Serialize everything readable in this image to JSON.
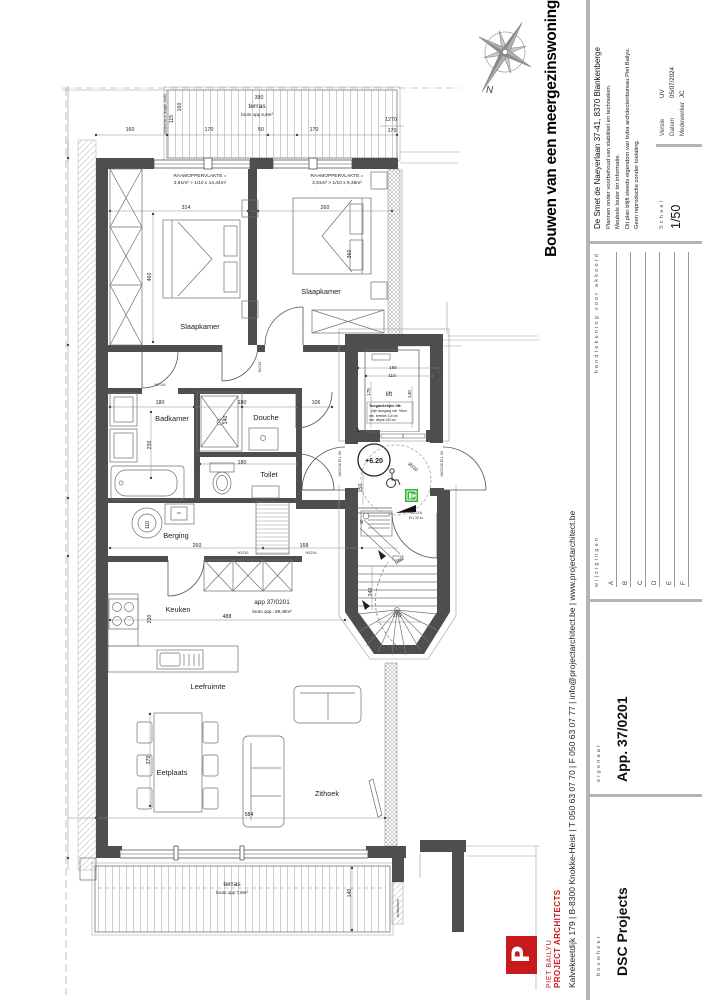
{
  "sheet": {
    "project_title": "Bouwen van een meergezinswoning",
    "project_address": "De Smet de Naeyerlaan 37-41, 8370 Blankenberge",
    "notes": "Plannen onder voorbehoud van stabiliteit en technieken.\nMeubels louter ter informatie.\nDit plan blijft steeds eigendom van bvba architectenbureau Piet Bailyu.\nGeen reproductie zonder toelating.",
    "versie_label": "Versie",
    "versie": "UV",
    "datum_label": "Datum",
    "datum": "05/07/2024",
    "medewerker_label": "Medewerker",
    "medewerker": "JC",
    "schaal_label": "Schaal",
    "schaal": "1/50",
    "wijzigingen_label": "wijzigingen",
    "handtekening_label": "handtekening voor akkoord",
    "revisions": [
      "A",
      "B",
      "C",
      "D",
      "E",
      "F"
    ],
    "bouwheer_label": "bouwheer",
    "bouwheer": "DSC Projects",
    "eigenaar_label": "eigenaar",
    "eigenaar": "App. 37/0201",
    "company_name": "PIET BAILYU",
    "company_sub": "PROJECT ARCHITECTS",
    "company_contact": "Kalvekeetdijk 179   |   B-8300 Knokke-Heist   |   T 050 63 07 70   |   F 050 63 07 77   |   info@projectarchitect.be   |   www.projectarchitect.be",
    "logo_letter": "P",
    "compass_label": "N"
  },
  "colors": {
    "wall": "#4e4e4e",
    "accent_red": "#c8191c",
    "exit_green": "#2eb135",
    "bar_gray": "#b3b3b3"
  },
  "plan": {
    "labels": [
      {
        "n": "label-terras-top",
        "t": "terras",
        "x": 257,
        "y": 108,
        "s": 6.8
      },
      {
        "n": "label-terras-top-opp",
        "t": "bruto opp 6,8m²",
        "x": 257,
        "y": 116,
        "s": 4.5
      },
      {
        "n": "label-slaapkamer-1",
        "t": "Slaapkamer",
        "x": 200,
        "y": 329,
        "s": 7.4
      },
      {
        "n": "label-slaapkamer-2",
        "t": "Slaapkamer",
        "x": 321,
        "y": 294,
        "s": 7.4
      },
      {
        "n": "label-badkamer",
        "t": "Badkamer",
        "x": 172,
        "y": 421,
        "s": 7.4
      },
      {
        "n": "label-douche",
        "t": "Douche",
        "x": 266,
        "y": 420,
        "s": 7.4
      },
      {
        "n": "label-toilet",
        "t": "Toilet",
        "x": 269,
        "y": 477,
        "s": 7.4
      },
      {
        "n": "label-berging",
        "t": "Berging",
        "x": 176,
        "y": 538,
        "s": 7.4
      },
      {
        "n": "label-keuken",
        "t": "Keuken",
        "x": 178,
        "y": 612,
        "s": 7.4
      },
      {
        "n": "label-leefruimte",
        "t": "Leefruimte",
        "x": 208,
        "y": 689,
        "s": 7.4
      },
      {
        "n": "label-eetplaats",
        "t": "Eetplaats",
        "x": 172,
        "y": 775,
        "s": 7.4
      },
      {
        "n": "label-zithoek",
        "t": "Zithoek",
        "x": 327,
        "y": 796,
        "s": 7.4
      },
      {
        "n": "label-lift",
        "t": "lift",
        "x": 389,
        "y": 396,
        "s": 6.4
      },
      {
        "n": "label-terras-bottom",
        "t": "terras",
        "x": 232,
        "y": 886,
        "s": 6.8
      },
      {
        "n": "label-terras-bottom-opp",
        "t": "bruto opp 7,8m²",
        "x": 232,
        "y": 894,
        "s": 4.5
      },
      {
        "n": "label-app-number",
        "t": "app 37/0201",
        "x": 272,
        "y": 604,
        "s": 6.4
      },
      {
        "n": "label-app-opp",
        "t": "bruto opp.: 89,48m²",
        "x": 272,
        "y": 613,
        "s": 4.5
      },
      {
        "n": "label-level",
        "t": "+6.20",
        "x": 374,
        "y": 463,
        "s": 7,
        "b": 1
      },
      {
        "n": "label-raam1-1",
        "t": "RAAMOPPERVLAKTE =",
        "x": 200,
        "y": 177,
        "s": 4.8
      },
      {
        "n": "label-raam1-2",
        "t": "3,91m² > 1/10 x 14,44m²",
        "x": 200,
        "y": 184,
        "s": 4.8
      },
      {
        "n": "label-raam2-1",
        "t": "RAAMOPPERVLAKTE =",
        "x": 337,
        "y": 177,
        "s": 4.8
      },
      {
        "n": "label-raam2-2",
        "t": "3,91m² > 1/10 x 9,36m²",
        "x": 337,
        "y": 184,
        "s": 4.8
      },
      {
        "n": "dim-390",
        "t": "390",
        "x": 259,
        "y": 99
      },
      {
        "n": "dim-160-a",
        "t": "160",
        "x": 130,
        "y": 131
      },
      {
        "n": "dim-170-a",
        "t": "170",
        "x": 209,
        "y": 131
      },
      {
        "n": "dim-50",
        "t": "50",
        "x": 261,
        "y": 131
      },
      {
        "n": "dim-170-b",
        "t": "170",
        "x": 314,
        "y": 131
      },
      {
        "n": "dim-1270",
        "t": "1270",
        "x": 391,
        "y": 121
      },
      {
        "n": "dim-170-c",
        "t": "170",
        "x": 392,
        "y": 132
      },
      {
        "n": "dim-160-v",
        "t": "160",
        "x": 181,
        "y": 107,
        "r": -90
      },
      {
        "n": "dim-115-v",
        "t": "115",
        "x": 173,
        "y": 119,
        "r": -90
      },
      {
        "n": "note-zichtscherm-top",
        "t": "zichtscherm hoogte 1m80",
        "x": 166,
        "y": 114,
        "r": -90,
        "s": 3.5
      },
      {
        "n": "dim-314",
        "t": "314",
        "x": 186,
        "y": 209
      },
      {
        "n": "dim-460",
        "t": "460",
        "x": 151,
        "y": 277,
        "r": -90
      },
      {
        "n": "dim-260-bed",
        "t": "260",
        "x": 325,
        "y": 209
      },
      {
        "n": "dim-360",
        "t": "360",
        "x": 351,
        "y": 254,
        "r": -90
      },
      {
        "n": "dim-180-badkamer",
        "t": "180",
        "x": 160,
        "y": 404
      },
      {
        "n": "dim-180-douche",
        "t": "180",
        "x": 242,
        "y": 404
      },
      {
        "n": "dim-106",
        "t": "106",
        "x": 316,
        "y": 404
      },
      {
        "n": "dim-140-douche",
        "t": "140",
        "x": 227,
        "y": 420,
        "r": -90
      },
      {
        "n": "dim-230-badkamer",
        "t": "230",
        "x": 151,
        "y": 445,
        "r": -90
      },
      {
        "n": "dim-180-toilet",
        "t": "180",
        "x": 242,
        "y": 464
      },
      {
        "n": "dim-260-berging",
        "t": "260",
        "x": 197,
        "y": 547
      },
      {
        "n": "dim-168",
        "t": "168",
        "x": 304,
        "y": 547
      },
      {
        "n": "dim-110",
        "t": "110",
        "x": 149,
        "y": 525,
        "r": -90
      },
      {
        "n": "dim-230-keuken",
        "t": "230",
        "x": 151,
        "y": 619,
        "r": -90
      },
      {
        "n": "dim-488",
        "t": "488",
        "x": 227,
        "y": 618
      },
      {
        "n": "dim-370",
        "t": "370",
        "x": 150,
        "y": 760,
        "r": -90
      },
      {
        "n": "dim-584",
        "t": "584",
        "x": 249,
        "y": 816
      },
      {
        "n": "dim-140-terras",
        "t": "140",
        "x": 351,
        "y": 893,
        "r": -90
      },
      {
        "n": "note-zichtscherm-bottom",
        "t": "zichtscherm",
        "x": 399,
        "y": 908,
        "r": -90,
        "s": 3.5
      },
      {
        "n": "dim-160-lift",
        "t": "160",
        "x": 393,
        "y": 369,
        "s": 4.6
      },
      {
        "n": "dim-110-lift",
        "t": "110",
        "x": 392,
        "y": 377,
        "s": 4.6
      },
      {
        "n": "dim-175-lift",
        "t": "175",
        "x": 370,
        "y": 392,
        "r": -90,
        "s": 4.6
      },
      {
        "n": "dim-140-lift",
        "t": "140",
        "x": 411,
        "y": 394,
        "r": -90,
        "s": 4.6
      },
      {
        "n": "dim-15-lift",
        "t": "15",
        "x": 359,
        "y": 430,
        "r": -90,
        "s": 4.2
      },
      {
        "n": "note-lift-title",
        "t": "Toegankelijke lift:",
        "x": 369,
        "y": 407,
        "s": 3.9,
        "a": "s",
        "b": 1
      },
      {
        "n": "note-lift-1",
        "t": "vrije doorgang min. 90cm",
        "x": 371,
        "y": 412,
        "s": 3.2,
        "a": "s"
      },
      {
        "n": "note-lift-2",
        "t": "min. breedte 110 cm",
        "x": 369,
        "y": 417,
        "s": 3.2,
        "a": "s"
      },
      {
        "n": "note-lift-3",
        "t": "min. diepte 140 cm",
        "x": 369,
        "y": 421,
        "s": 3.2,
        "a": "s"
      },
      {
        "n": "dim-150-landing",
        "t": "150",
        "x": 362,
        "y": 488,
        "r": -90
      },
      {
        "n": "dim-diam150",
        "t": "Ø150",
        "x": 412,
        "y": 468,
        "r": 42,
        "s": 4.6
      },
      {
        "n": "dim-240",
        "t": "240",
        "x": 372,
        "y": 592,
        "r": -90
      },
      {
        "n": "dim-170-stair",
        "t": "170",
        "x": 397,
        "y": 617
      },
      {
        "n": "dim-r60",
        "t": "R60",
        "x": 400,
        "y": 562,
        "r": -42,
        "s": 4.6
      },
      {
        "n": "dim-40",
        "t": "40",
        "x": 363,
        "y": 522,
        "r": -90,
        "s": 4.4
      },
      {
        "n": "door-90216-a",
        "t": "90/216",
        "x": 160,
        "y": 386,
        "s": 3.6,
        "c": "#333"
      },
      {
        "n": "door-90216-b",
        "t": "90/216",
        "x": 261,
        "y": 367,
        "r": -90,
        "s": 3.6,
        "c": "#333"
      },
      {
        "n": "door-90216-c",
        "t": "90/216",
        "x": 243,
        "y": 554,
        "s": 3.6,
        "c": "#333"
      },
      {
        "n": "door-90216-d",
        "t": "90/216",
        "x": 311,
        "y": 554,
        "s": 3.6,
        "c": "#333"
      },
      {
        "n": "door-180236-left",
        "t": "180/236 EI1 30",
        "x": 341,
        "y": 464,
        "r": -90,
        "s": 3.8,
        "c": "#333"
      },
      {
        "n": "door-180236-right",
        "t": "180/236 EI1 30",
        "x": 443,
        "y": 464,
        "r": -90,
        "s": 3.8,
        "c": "#333"
      },
      {
        "n": "door-90216-stair",
        "t": "90/216",
        "x": 416,
        "y": 514,
        "s": 3.8,
        "c": "#333"
      },
      {
        "n": "door-ei130zs",
        "t": "EI1 30 zs",
        "x": 416,
        "y": 519,
        "s": 3.4,
        "c": "#333"
      },
      {
        "n": "label-cv",
        "t": "cv",
        "x": 179,
        "y": 514,
        "s": 3.8,
        "c": "#333"
      }
    ]
  }
}
